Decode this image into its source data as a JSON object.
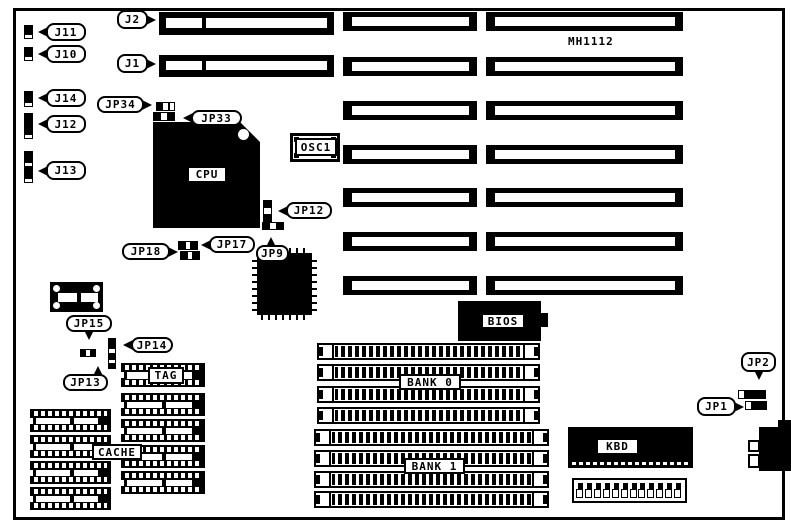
{
  "model_label": "MH1112",
  "colors": {
    "ink": "#000000",
    "background": "#ffffff"
  },
  "board_outline": {
    "x": 13,
    "y": 8,
    "w": 772,
    "h": 512
  },
  "model_pos": {
    "x": 568,
    "y": 35,
    "w": 64,
    "h": 13
  },
  "slots": {
    "left_double": [
      {
        "id": "J2",
        "x": 159,
        "y": 12,
        "w": 175,
        "h": 23
      },
      {
        "id": "J1",
        "x": 159,
        "y": 55,
        "w": 175,
        "h": 22
      }
    ],
    "middle": [
      {
        "x": 343,
        "y": 12,
        "w": 134,
        "h": 19
      },
      {
        "x": 343,
        "y": 57,
        "w": 134,
        "h": 19
      },
      {
        "x": 343,
        "y": 101,
        "w": 134,
        "h": 19
      },
      {
        "x": 343,
        "y": 145,
        "w": 134,
        "h": 19
      },
      {
        "x": 343,
        "y": 188,
        "w": 134,
        "h": 19
      },
      {
        "x": 343,
        "y": 232,
        "w": 134,
        "h": 19
      },
      {
        "x": 343,
        "y": 276,
        "w": 134,
        "h": 19
      }
    ],
    "right": [
      {
        "x": 486,
        "y": 12,
        "w": 197,
        "h": 19
      },
      {
        "x": 486,
        "y": 57,
        "w": 197,
        "h": 19
      },
      {
        "x": 486,
        "y": 101,
        "w": 197,
        "h": 19
      },
      {
        "x": 486,
        "y": 145,
        "w": 197,
        "h": 19
      },
      {
        "x": 486,
        "y": 188,
        "w": 197,
        "h": 19
      },
      {
        "x": 486,
        "y": 232,
        "w": 197,
        "h": 19
      },
      {
        "x": 486,
        "y": 276,
        "w": 197,
        "h": 19
      }
    ]
  },
  "jumpers": [
    {
      "id": "J11",
      "x": 24,
      "y": 25,
      "w": 9,
      "h": 14,
      "dir": "v",
      "cells": [
        "b",
        "b",
        "w"
      ]
    },
    {
      "id": "J10",
      "x": 24,
      "y": 47,
      "w": 9,
      "h": 14,
      "dir": "v",
      "cells": [
        "b",
        "b",
        "w"
      ]
    },
    {
      "id": "J14",
      "x": 24,
      "y": 91,
      "w": 9,
      "h": 16,
      "dir": "v",
      "cells": [
        "b",
        "b",
        "w"
      ]
    },
    {
      "id": "J12",
      "x": 24,
      "y": 113,
      "w": 9,
      "h": 26,
      "dir": "v",
      "cells": [
        "b",
        "b",
        "b",
        "b",
        "w"
      ]
    },
    {
      "id": "J13",
      "x": 24,
      "y": 151,
      "w": 9,
      "h": 32,
      "dir": "v",
      "cells": [
        "b",
        "b",
        "w",
        "b",
        "b",
        "w"
      ]
    },
    {
      "id": "JP34",
      "x": 156,
      "y": 102,
      "w": 19,
      "h": 9,
      "dir": "h",
      "cells": [
        "b",
        "w",
        "w"
      ]
    },
    {
      "id": "JP33",
      "x": 153,
      "y": 112,
      "w": 22,
      "h": 9,
      "dir": "h",
      "cells": [
        "b",
        "w",
        "b"
      ]
    },
    {
      "id": "JP12",
      "x": 263,
      "y": 200,
      "w": 9,
      "h": 22,
      "dir": "v",
      "cells": [
        "b",
        "w",
        "b"
      ]
    },
    {
      "id": "JP9",
      "x": 262,
      "y": 222,
      "w": 22,
      "h": 8,
      "dir": "h",
      "cells": [
        "b",
        "w",
        "b"
      ]
    },
    {
      "id": "JP17",
      "x": 178,
      "y": 241,
      "w": 20,
      "h": 9,
      "dir": "h",
      "cells": [
        "b",
        "w",
        "b"
      ]
    },
    {
      "id": "JP18",
      "x": 180,
      "y": 251,
      "w": 20,
      "h": 9,
      "dir": "h",
      "cells": [
        "b",
        "w",
        "b"
      ]
    },
    {
      "id": "JP15",
      "x": 80,
      "y": 349,
      "w": 16,
      "h": 8,
      "dir": "h",
      "cells": [
        "b",
        "w",
        "b"
      ]
    },
    {
      "id": "JP14",
      "x": 108,
      "y": 338,
      "w": 8,
      "h": 31,
      "dir": "v",
      "cells": [
        "b",
        "b",
        "w",
        "b",
        "w",
        "b"
      ]
    },
    {
      "id": "JP2",
      "x": 738,
      "y": 390,
      "w": 28,
      "h": 9,
      "dir": "h",
      "cells": [
        "w",
        "b",
        "b",
        "b"
      ]
    },
    {
      "id": "JP1",
      "x": 745,
      "y": 401,
      "w": 22,
      "h": 9,
      "dir": "h",
      "cells": [
        "w",
        "b",
        "b"
      ]
    }
  ],
  "callouts": [
    {
      "id": "J11",
      "label": "J11",
      "x": 46,
      "y": 23,
      "w": 40,
      "h": 18,
      "ptr": "left"
    },
    {
      "id": "J10",
      "label": "J10",
      "x": 46,
      "y": 45,
      "w": 40,
      "h": 18,
      "ptr": "left"
    },
    {
      "id": "J14",
      "label": "J14",
      "x": 46,
      "y": 89,
      "w": 40,
      "h": 18,
      "ptr": "left"
    },
    {
      "id": "J12",
      "label": "J12",
      "x": 46,
      "y": 115,
      "w": 40,
      "h": 18,
      "ptr": "left"
    },
    {
      "id": "J13",
      "label": "J13",
      "x": 46,
      "y": 161,
      "w": 40,
      "h": 19,
      "ptr": "left"
    },
    {
      "id": "J2",
      "label": "J2",
      "x": 117,
      "y": 10,
      "w": 31,
      "h": 19,
      "ptr": "right"
    },
    {
      "id": "J1",
      "label": "J1",
      "x": 117,
      "y": 54,
      "w": 31,
      "h": 19,
      "ptr": "right"
    },
    {
      "id": "JP34",
      "label": "JP34",
      "x": 97,
      "y": 96,
      "w": 47,
      "h": 17,
      "ptr": "right"
    },
    {
      "id": "JP33",
      "label": "JP33",
      "x": 191,
      "y": 110,
      "w": 51,
      "h": 16,
      "ptr": "left"
    },
    {
      "id": "JP12",
      "label": "JP12",
      "x": 286,
      "y": 202,
      "w": 46,
      "h": 17,
      "ptr": "left"
    },
    {
      "id": "JP9",
      "label": "JP9",
      "x": 256,
      "y": 245,
      "w": 33,
      "h": 17,
      "ptr": "up",
      "po": 45
    },
    {
      "id": "JP18",
      "label": "JP18",
      "x": 122,
      "y": 243,
      "w": 48,
      "h": 17,
      "ptr": "right"
    },
    {
      "id": "JP17",
      "label": "JP17",
      "x": 209,
      "y": 236,
      "w": 46,
      "h": 17,
      "ptr": "left"
    },
    {
      "id": "JP15",
      "label": "JP15",
      "x": 66,
      "y": 315,
      "w": 46,
      "h": 17,
      "ptr": "down",
      "po": 50
    },
    {
      "id": "JP14",
      "label": "JP14",
      "x": 131,
      "y": 337,
      "w": 42,
      "h": 16,
      "ptr": "left"
    },
    {
      "id": "JP13",
      "label": "JP13",
      "x": 63,
      "y": 374,
      "w": 45,
      "h": 17,
      "ptr": "up",
      "po": 80
    },
    {
      "id": "JP2",
      "label": "JP2",
      "x": 741,
      "y": 352,
      "w": 35,
      "h": 20,
      "ptr": "down",
      "po": 50
    },
    {
      "id": "JP1",
      "label": "JP1",
      "x": 697,
      "y": 397,
      "w": 39,
      "h": 19,
      "ptr": "right"
    }
  ],
  "dip_chips": {
    "left_column": [
      {
        "x": 30,
        "y": 409,
        "w": 81,
        "h": 23
      },
      {
        "x": 30,
        "y": 435,
        "w": 81,
        "h": 23
      },
      {
        "x": 30,
        "y": 461,
        "w": 81,
        "h": 23
      },
      {
        "x": 30,
        "y": 487,
        "w": 81,
        "h": 23
      }
    ],
    "right_column": [
      {
        "x": 121,
        "y": 363,
        "w": 84,
        "h": 24
      },
      {
        "x": 121,
        "y": 393,
        "w": 84,
        "h": 23
      },
      {
        "x": 121,
        "y": 419,
        "w": 84,
        "h": 23
      },
      {
        "x": 121,
        "y": 445,
        "w": 84,
        "h": 23
      },
      {
        "x": 121,
        "y": 471,
        "w": 84,
        "h": 23
      }
    ]
  },
  "simm_rows": {
    "bank0": [
      {
        "x": 317,
        "y": 343,
        "w": 223,
        "h": 17
      },
      {
        "x": 317,
        "y": 364,
        "w": 223,
        "h": 17
      },
      {
        "x": 317,
        "y": 386,
        "w": 223,
        "h": 17
      },
      {
        "x": 317,
        "y": 407,
        "w": 223,
        "h": 17
      }
    ],
    "bank1": [
      {
        "x": 314,
        "y": 429,
        "w": 235,
        "h": 17
      },
      {
        "x": 314,
        "y": 450,
        "w": 235,
        "h": 17
      },
      {
        "x": 314,
        "y": 471,
        "w": 235,
        "h": 17
      },
      {
        "x": 314,
        "y": 491,
        "w": 235,
        "h": 17
      }
    ]
  },
  "labels": [
    {
      "id": "cpu",
      "text": "CPU",
      "x": 187,
      "y": 166,
      "w": 40,
      "h": 17
    },
    {
      "id": "osc1",
      "text": "OSC1",
      "x": 295,
      "y": 138,
      "w": 42,
      "h": 18
    },
    {
      "id": "tag",
      "text": "TAG",
      "x": 148,
      "y": 367,
      "w": 36,
      "h": 17
    },
    {
      "id": "cache",
      "text": "CACHE",
      "x": 92,
      "y": 444,
      "w": 50,
      "h": 16
    },
    {
      "id": "bank0",
      "text": "BANK 0",
      "x": 399,
      "y": 374,
      "w": 62,
      "h": 16
    },
    {
      "id": "bank1",
      "text": "BANK 1",
      "x": 404,
      "y": 458,
      "w": 61,
      "h": 16
    },
    {
      "id": "bios",
      "text": "BIOS",
      "x": 481,
      "y": 313,
      "w": 44,
      "h": 16
    },
    {
      "id": "kbd",
      "text": "KBD",
      "x": 596,
      "y": 438,
      "w": 43,
      "h": 17
    }
  ],
  "parts": {
    "cpu": {
      "x": 153,
      "y": 122,
      "w": 107,
      "h": 106
    },
    "osc1": {
      "x": 290,
      "y": 133,
      "w": 50,
      "h": 29
    },
    "xtal": {
      "x": 50,
      "y": 282,
      "w": 53,
      "h": 30
    },
    "qfp": {
      "x": 252,
      "y": 248,
      "w": 65,
      "h": 72
    },
    "bios": {
      "x": 458,
      "y": 301,
      "w": 83,
      "h": 40
    },
    "bios_tab": {
      "x": 541,
      "y": 313,
      "w": 7,
      "h": 14
    },
    "kbd": {
      "x": 568,
      "y": 427,
      "w": 125,
      "h": 41
    },
    "kbd_strip": {
      "x": 572,
      "y": 478,
      "w": 115,
      "h": 25,
      "pins": 12
    },
    "din_main": {
      "x": 759,
      "y": 427,
      "w": 32,
      "h": 44
    },
    "din_step": {
      "x": 778,
      "y": 420,
      "w": 13,
      "h": 9
    },
    "din_pins": [
      {
        "x": 748,
        "y": 440,
        "w": 12,
        "h": 12
      },
      {
        "x": 748,
        "y": 454,
        "w": 12,
        "h": 14
      }
    ]
  }
}
